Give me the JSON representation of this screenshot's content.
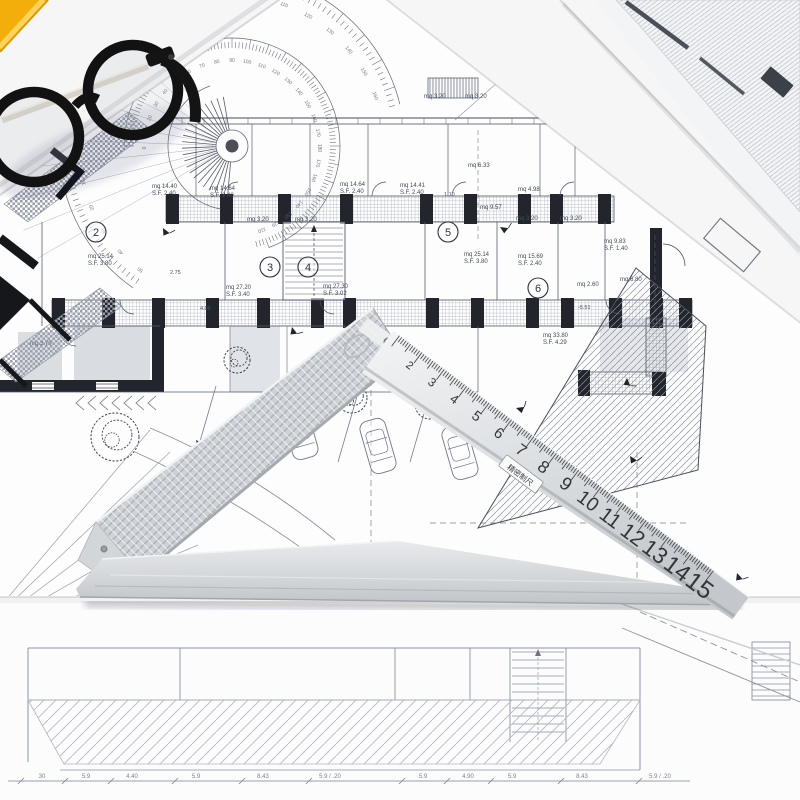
{
  "rulers": {
    "metal_square": {
      "scale_numbers": [
        "2",
        "3",
        "4",
        "5",
        "6",
        "7",
        "8",
        "9",
        "10",
        "11",
        "12",
        "13",
        "14",
        "15"
      ],
      "sticker_text": "精密制尺"
    },
    "red_square": {
      "leg_numbers": [
        "10",
        "20",
        "30"
      ],
      "hyp_numbers": [
        "5",
        "10",
        "15",
        "20",
        "25"
      ]
    }
  },
  "blueprint_main": {
    "room_numbers": [
      "2",
      "3",
      "4",
      "5",
      "6"
    ],
    "area_labels": [
      {
        "mq": "mq 14.40",
        "sf": "S.F. 2.40"
      },
      {
        "mq": "mq 14.64",
        "sf": "S.F. 2.40"
      },
      {
        "mq": "mq 14.64",
        "sf": "S.F. 2.40"
      },
      {
        "mq": "mq 14.41",
        "sf": "S.F. 2.40"
      },
      {
        "mq": "mq 6.33",
        "sf": ""
      },
      {
        "mq": "mq 9.57",
        "sf": ""
      },
      {
        "mq": "mq 3.20",
        "sf": ""
      },
      {
        "mq": "mq 3.20",
        "sf": ""
      },
      {
        "mq": "mq 3.20",
        "sf": ""
      },
      {
        "mq": "mq 3.20",
        "sf": ""
      },
      {
        "mq": "mq 3.20",
        "sf": ""
      },
      {
        "mq": "mq 3.20",
        "sf": ""
      },
      {
        "mq": "mq 25.14",
        "sf": "S.F. 3.80"
      },
      {
        "mq": "mq 25.14",
        "sf": "S.F. 3.80"
      },
      {
        "mq": "mq 27.20",
        "sf": "S.F. 3.40"
      },
      {
        "mq": "mq 27.30",
        "sf": "S.F. 3.02"
      },
      {
        "mq": "mq 15.69",
        "sf": "S.F. 2.40"
      },
      {
        "mq": "mq 9.83",
        "sf": "S.F. 1.40"
      },
      {
        "mq": "mq 6.80",
        "sf": ""
      },
      {
        "mq": "mq 2.60",
        "sf": ""
      },
      {
        "mq": "mq 33.80",
        "sf": "S.F. 4.29"
      },
      {
        "mq": "mq 4.98",
        "sf": ""
      },
      {
        "mq": "mq 3.79",
        "sf": ""
      }
    ],
    "small_dims": [
      "1.10",
      "4.05",
      "-5.51",
      "2.75"
    ],
    "protractor_degrees": [
      "0",
      "10",
      "20",
      "30",
      "40",
      "50",
      "60",
      "70",
      "80",
      "90",
      "100",
      "110",
      "120",
      "130",
      "140",
      "150",
      "160",
      "170",
      "180"
    ]
  },
  "blueprint_bottom": {
    "dimension_labels": [
      "30",
      "5.9",
      "4.40",
      "5.9",
      "8.43",
      "5.9 / .20",
      "5.9",
      "4.90",
      "5.9",
      "8.43",
      "5.9 / .20"
    ]
  }
}
